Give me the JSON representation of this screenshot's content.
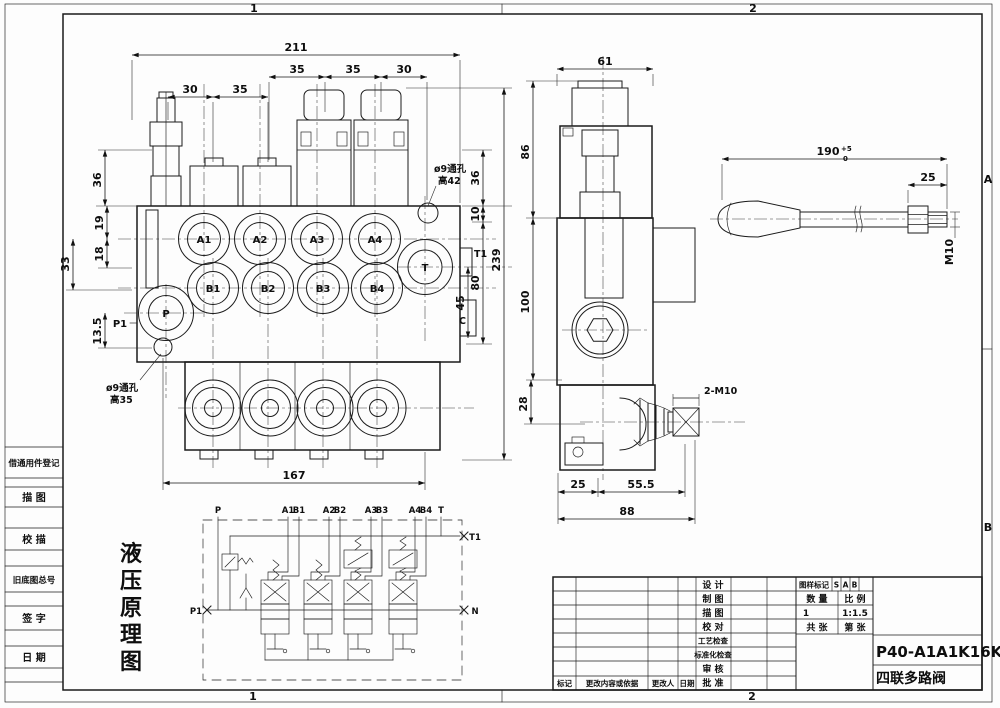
{
  "frame": {
    "zones_top": [
      "1",
      "2"
    ],
    "zones_bottom": [
      "1",
      "2"
    ],
    "zones_right": [
      "A",
      "B"
    ]
  },
  "sidebar": {
    "items": [
      "借通用件登记",
      "描 图",
      "校 描",
      "旧底图总号",
      "签 字",
      "日 期"
    ]
  },
  "front": {
    "dims": {
      "total_w": "211",
      "w35a": "35",
      "w35b": "35",
      "w30r": "30",
      "w30l": "30",
      "w35l": "35",
      "h36l": "36",
      "h19": "19",
      "h18": "18",
      "h33": "33",
      "h135": "13.5",
      "h36r": "36",
      "h10": "10",
      "h239": "239",
      "h80": "80",
      "h45": "45",
      "bottom_w": "167"
    },
    "ports": {
      "a": [
        "A1",
        "A2",
        "A3",
        "A4"
      ],
      "b": [
        "B1",
        "B2",
        "B3",
        "B4"
      ],
      "p": "P",
      "t": "T",
      "p1": "P1",
      "t1": "T1",
      "c": "C"
    },
    "notes": {
      "hole_top_1": "ø9通孔",
      "hole_top_2": "高42",
      "hole_bot_1": "ø9通孔",
      "hole_bot_2": "高35"
    }
  },
  "side": {
    "dims": {
      "w61": "61",
      "h86": "86",
      "h100": "100",
      "h28": "28",
      "b25": "25",
      "b555": "55.5",
      "b88": "88"
    },
    "labels": {
      "m10": "2-M10"
    }
  },
  "handle": {
    "dims": {
      "len": "190",
      "tol_up": "+5",
      "tol_dn": "0",
      "d25": "25",
      "m10": "M10"
    }
  },
  "schematic": {
    "caption": [
      "液",
      "压",
      "原",
      "理",
      "图"
    ],
    "ports": {
      "p": "P",
      "a1": "A1",
      "b1": "B1",
      "a2": "A2",
      "b2": "B2",
      "a3": "A3",
      "b3": "B3",
      "a4": "A4",
      "b4": "B4",
      "t": "T",
      "t1": "T1",
      "n": "N",
      "p1": "P1"
    }
  },
  "tb": {
    "rows": [
      "设  计",
      "制  图",
      "描  图",
      "校  对",
      "工艺检查",
      "标准化检查",
      "审  核",
      "批  准"
    ],
    "bottom": [
      "标记",
      "更改内容或依据",
      "更改人",
      "日期"
    ],
    "stamp": {
      "mark": "图样标记",
      "s": "S",
      "a": "A",
      "b": "B",
      "qty_l": "数  量",
      "scale_l": "比  例",
      "qty": "1",
      "scale": "1:1.5",
      "total": "共  张",
      "sheet": "第  张"
    },
    "part_no": "P40-A1A1K16K16",
    "part_name": "四联多路阀"
  }
}
